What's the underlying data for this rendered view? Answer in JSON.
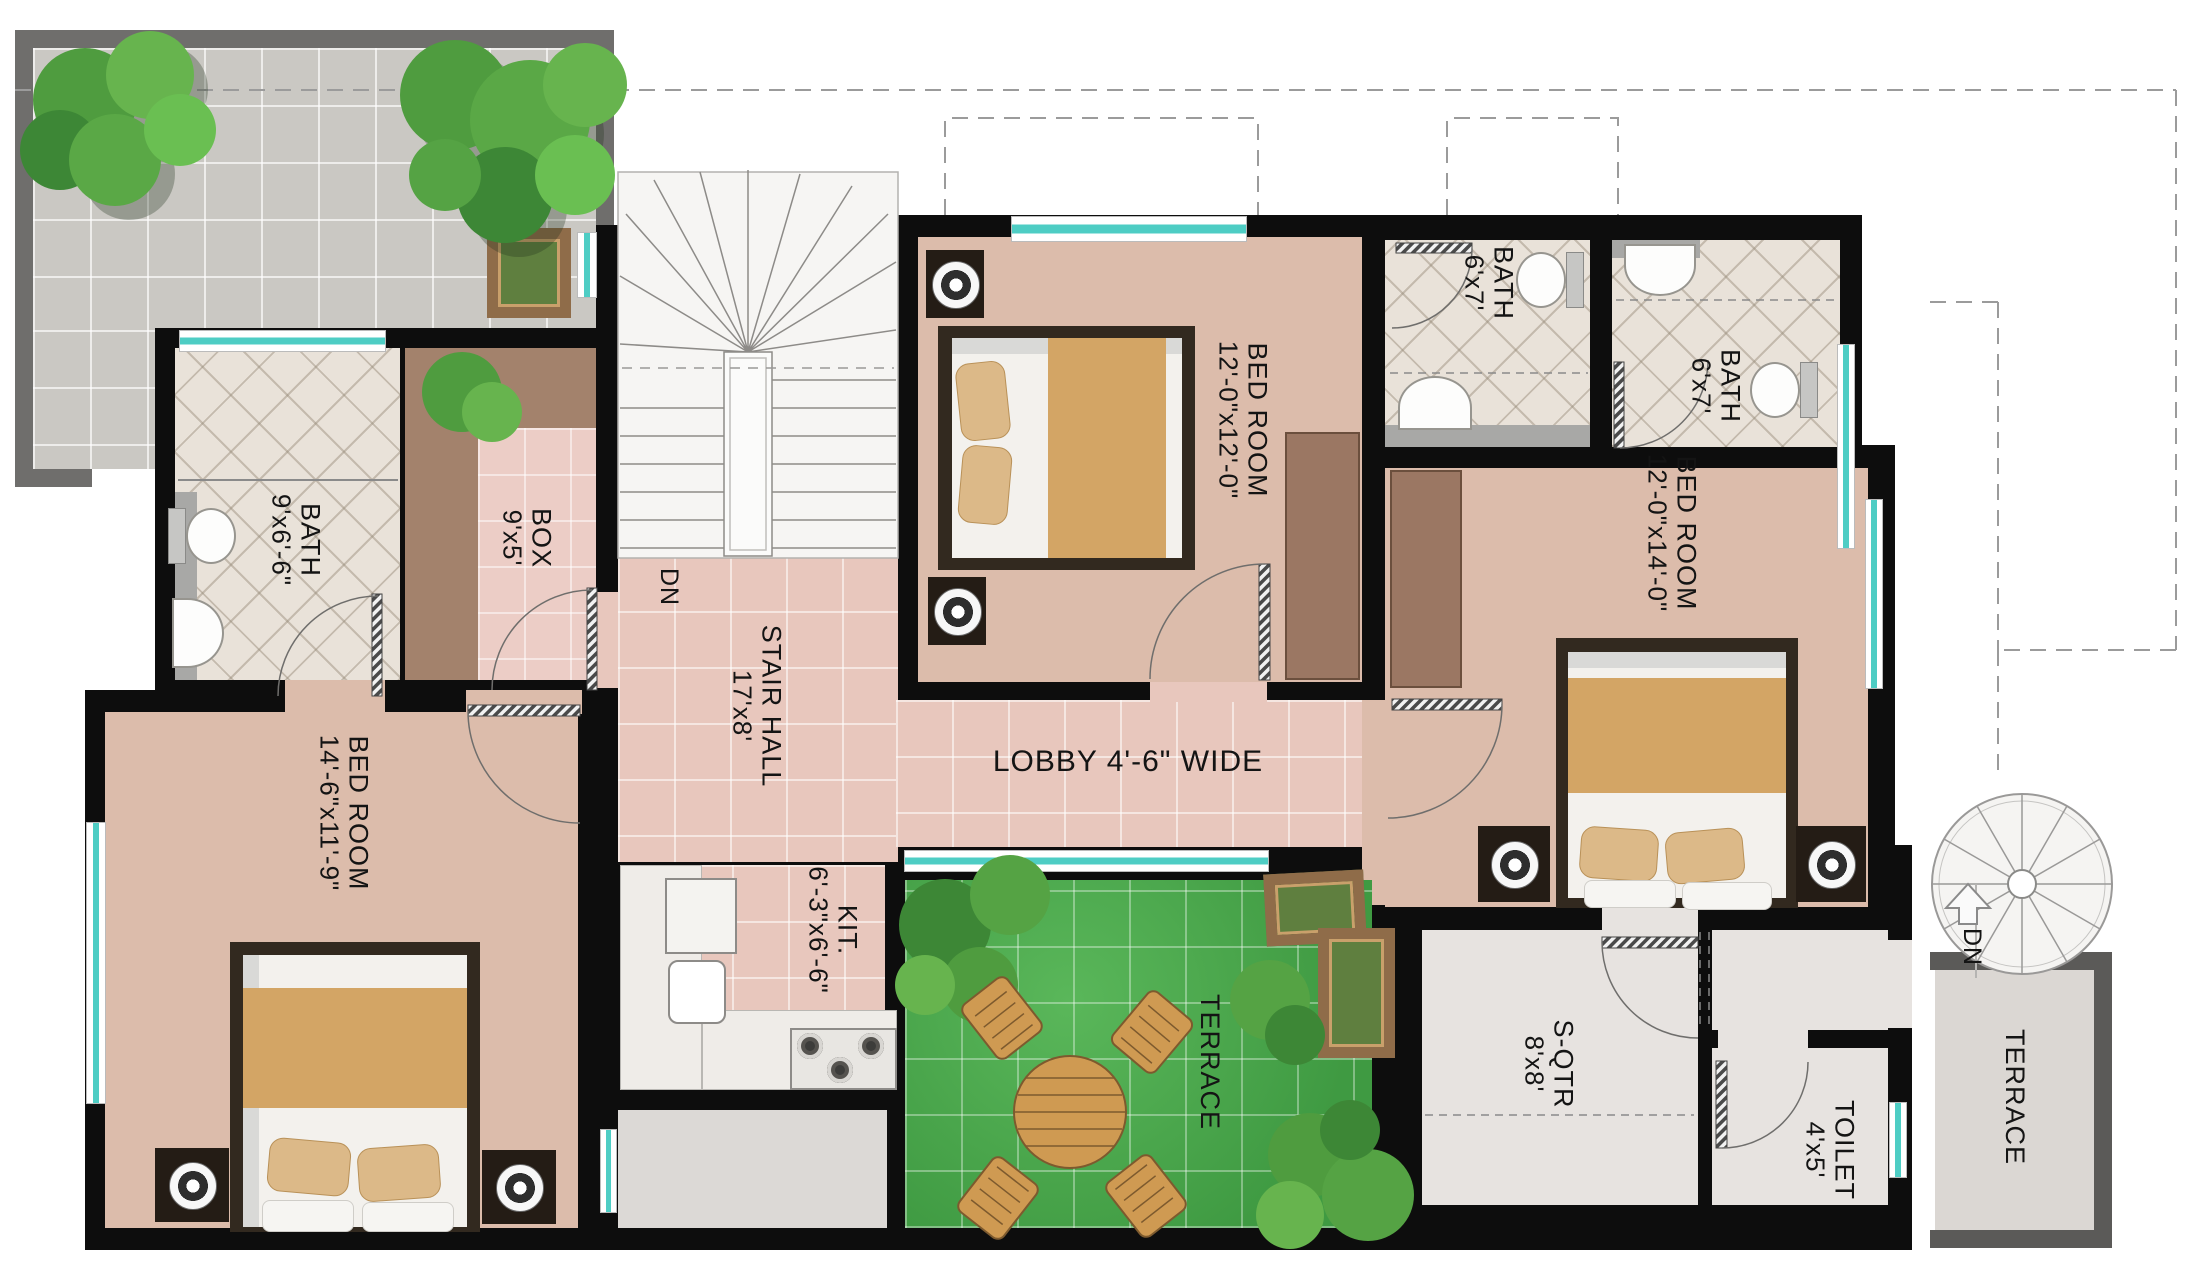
{
  "rooms": {
    "bath_main": {
      "label": "BATH",
      "dim": "9'x6'-6\""
    },
    "box": {
      "label": "BOX",
      "dim": "9'x5'"
    },
    "stair_hall": {
      "label": "STAIR HALL",
      "dim": "17'x8'"
    },
    "stair_dn": {
      "label": "DN"
    },
    "bedroom_top": {
      "label": "BED ROOM",
      "dim": "12'-0\"x12'-0\""
    },
    "bath_top_1": {
      "label": "BATH",
      "dim": "6'x7'"
    },
    "bath_top_2": {
      "label": "BATH",
      "dim": "6'x7'"
    },
    "bedroom_right": {
      "label": "BED ROOM",
      "dim": "12'-0\"x14'-0\""
    },
    "lobby": {
      "label": "LOBBY 4'-6\" WIDE"
    },
    "bedroom_left": {
      "label": "BED ROOM",
      "dim": "14'-6\"x11'-9\""
    },
    "kitchen": {
      "label": "KIT.",
      "dim": "6'-3\"x6'-6\""
    },
    "terrace_inner": {
      "label": "TERRACE"
    },
    "s_qtr": {
      "label": "S-QTR",
      "dim": "8'x8'"
    },
    "toilet": {
      "label": "TOILET",
      "dim": "4'x5'"
    },
    "terrace_right": {
      "label": "TERRACE"
    },
    "spiral_dn": {
      "label": "DN"
    }
  },
  "colors": {
    "wall": "#0d0d0d",
    "floor_bedroom": "#dcbcab",
    "floor_tile_pink": "#e8c7bd",
    "floor_bath": "#e9e2d9",
    "grass": "#4aa84d",
    "terrace_gray": "#cac8c3",
    "window_teal": "#4ecdc4",
    "wood_furniture": "#cf9a52",
    "wardrobe_brown": "#9b7763"
  }
}
